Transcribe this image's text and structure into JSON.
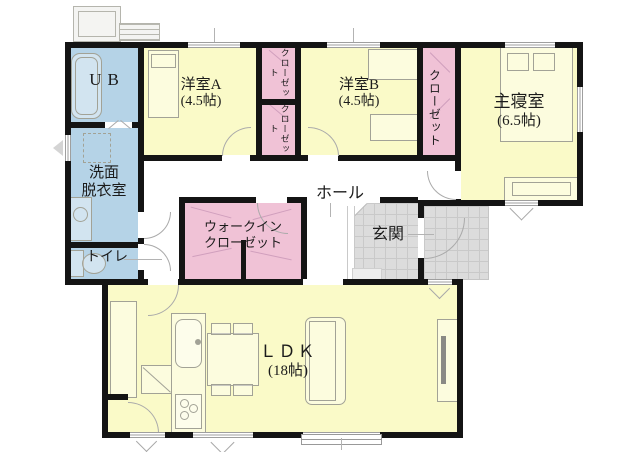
{
  "palette": {
    "wall": "#141414",
    "room_yellow": "#fafac8",
    "room_blue": "#b5d3e7",
    "room_pink": "#f0c2d6",
    "tile_gray": "#dcdcdc",
    "tile_grid": "#c9c9c9",
    "furniture_line": "#a2a296",
    "door_line": "#aaaaaa",
    "text": "#1b1b1b"
  },
  "rooms": {
    "ub": {
      "label": "UB"
    },
    "western_a": {
      "label": "洋室A",
      "size": "(4.5帖)"
    },
    "closet_ab_upper": {
      "label": "クローゼット"
    },
    "closet_ab_lower": {
      "label": "クローゼット"
    },
    "western_b": {
      "label": "洋室B",
      "size": "(4.5帖)"
    },
    "closet_master": {
      "label": "クローゼット"
    },
    "master_bedroom": {
      "label": "主寝室",
      "size": "(6.5帖)"
    },
    "washroom": {
      "label_line1": "洗面",
      "label_line2": "脱衣室"
    },
    "toilet": {
      "label": "トイレ"
    },
    "hall": {
      "label": "ホール"
    },
    "walk_in_closet": {
      "label_line1": "ウォークイン",
      "label_line2": "クローゼット"
    },
    "entrance": {
      "label": "玄関"
    },
    "ldk": {
      "label": "ＬＤＫ",
      "size": "(18帖)"
    }
  }
}
